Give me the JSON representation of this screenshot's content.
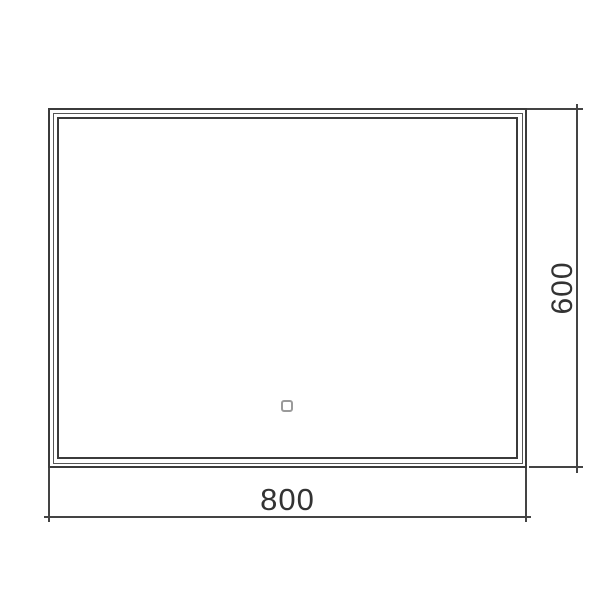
{
  "drawing": {
    "type": "technical-dimension-drawing",
    "subject": "rectangular LED mirror, front view",
    "background_color": "#ffffff",
    "line_color": "#3b3b3b",
    "thin_line_color": "#555555",
    "dimension_line_color": "#444444",
    "text_color": "#333333",
    "sensor_outline_color": "#9a9a9a",
    "dimensions": {
      "width": {
        "label": "800"
      },
      "height": {
        "label": "600"
      }
    },
    "touch_sensor": {
      "shape": "rounded-square-outline"
    }
  }
}
